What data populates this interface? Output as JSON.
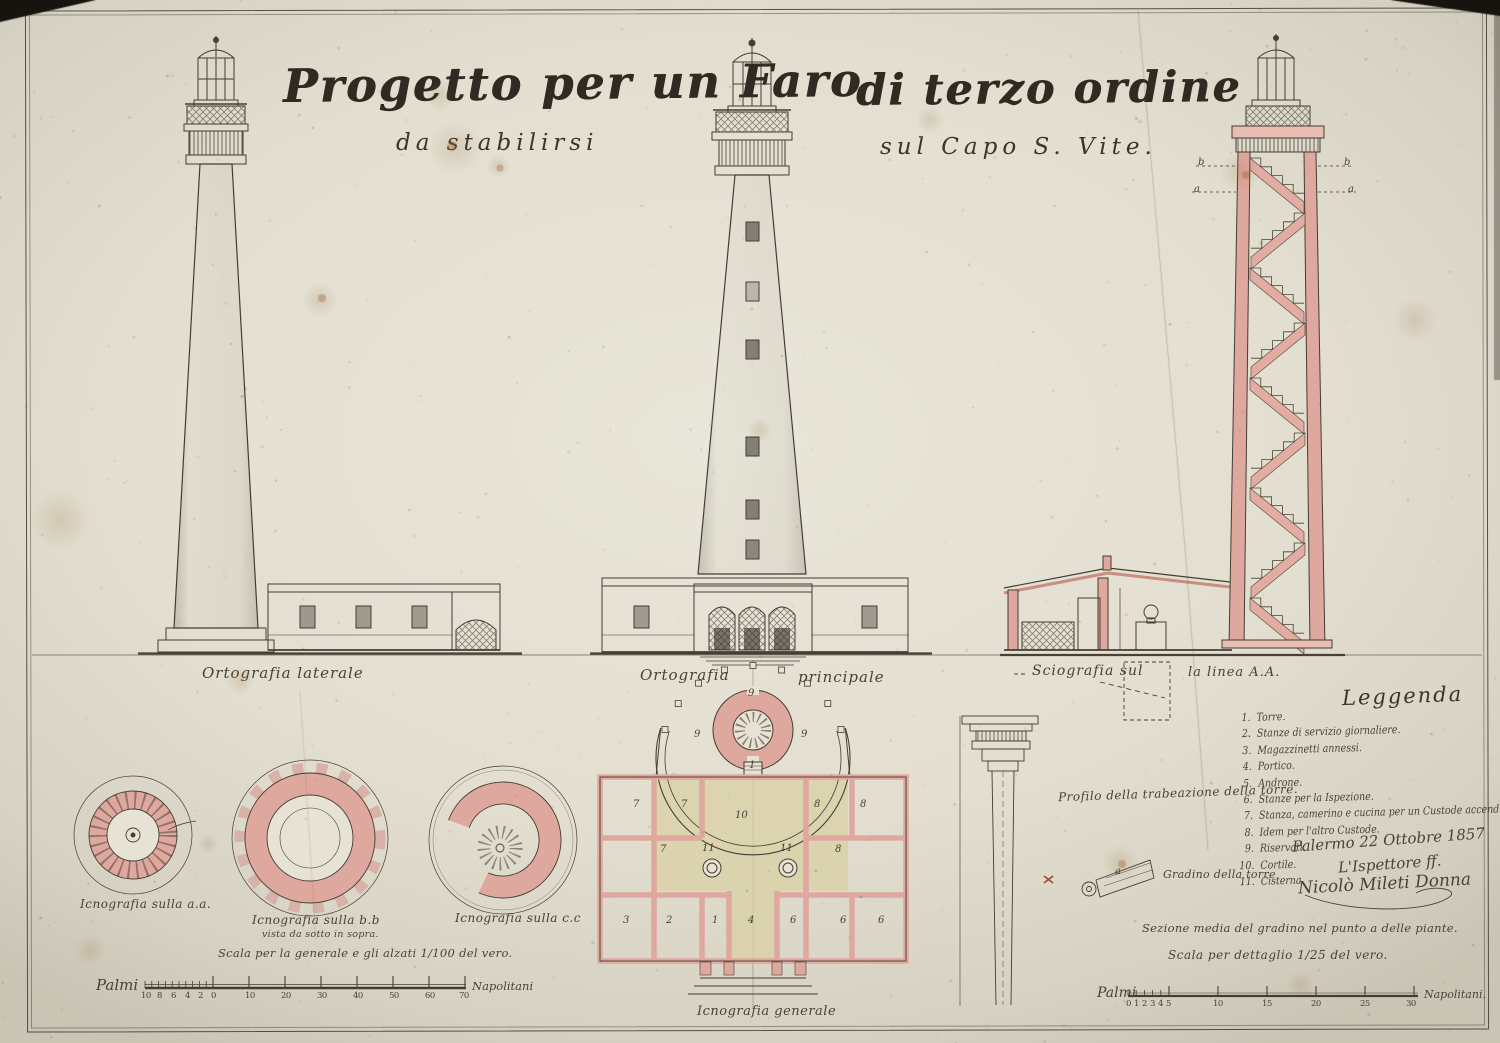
{
  "title": {
    "line1_left": "Progetto per un Faro",
    "line1_right": "di terzo ordine",
    "line2_left": "da stabilirsi",
    "line2_right": "sul Capo S. Vite."
  },
  "labels": {
    "elevation_lateral": "Ortografia laterale",
    "elevation_main_1": "Ortografia",
    "elevation_main_2": "principale",
    "section_1": "Sciografia sul",
    "section_2": "la linea A.A.",
    "plan_aa": "Icnografia sulla a.a.",
    "plan_bb": "Icnografia sulla b.b",
    "plan_bb_sub": "vista da sotto in sopra.",
    "plan_cc": "Icnografia sulla c.c",
    "plan_general": "Icnografia generale",
    "scale_main": "Scala per la generale e gli alzati 1/100 del vero.",
    "trabeazione": "Profilo della trabeazione della torre.",
    "gradino": "Gradino della torre",
    "gradino_section": "Sezione media del gradino nel punto a delle piante.",
    "scale_detail": "Scala per dettaglio 1/25 del vero."
  },
  "legend": {
    "title": "Leggenda",
    "items": [
      {
        "num": "1.",
        "text": "Torre."
      },
      {
        "num": "2.",
        "text": "Stanze di servizio giornaliere."
      },
      {
        "num": "3.",
        "text": "Magazzinetti annessi."
      },
      {
        "num": "4.",
        "text": "Portico."
      },
      {
        "num": "5.",
        "text": "Androne."
      },
      {
        "num": "6.",
        "text": "Stanze per la Ispezione."
      },
      {
        "num": "7.",
        "text": "Stanza, camerino e cucina per un Custode accenditore."
      },
      {
        "num": "8.",
        "text": "Idem per l'altro Custode."
      },
      {
        "num": "9.",
        "text": "Riservati."
      },
      {
        "num": "10.",
        "text": "Cortile."
      },
      {
        "num": "11.",
        "text": "Cisterna."
      }
    ]
  },
  "signature": {
    "line1": "Palermo 22 Ottobre 1857",
    "line2": "L'Ispettore ff.",
    "line3": "Nicolò Mileti Donna"
  },
  "scales": {
    "left": {
      "unit_left": "Palmi",
      "unit_right": "Napolitani"
    },
    "right": {
      "unit_left": "Palmi",
      "unit_right": "Napolitani."
    }
  },
  "colors": {
    "ink": "#443d33",
    "wash_pink": "#dfa89e",
    "wash_pink_light": "#e8bdb2",
    "wash_sand": "#d8d0a2",
    "paper": "#e6e2d4"
  },
  "annotations": [
    {
      "t": "9",
      "x": 748,
      "y": 688,
      "c": "num"
    },
    {
      "t": "9",
      "x": 694,
      "y": 729,
      "c": "num"
    },
    {
      "t": "9",
      "x": 801,
      "y": 729,
      "c": "num"
    },
    {
      "t": "1",
      "x": 749,
      "y": 760,
      "c": "num"
    },
    {
      "t": "10",
      "x": 735,
      "y": 810,
      "c": "num"
    },
    {
      "t": "11",
      "x": 702,
      "y": 843,
      "c": "num"
    },
    {
      "t": "11",
      "x": 780,
      "y": 843,
      "c": "num"
    },
    {
      "t": "7",
      "x": 633,
      "y": 799,
      "c": "num"
    },
    {
      "t": "7",
      "x": 681,
      "y": 799,
      "c": "num"
    },
    {
      "t": "7",
      "x": 660,
      "y": 844,
      "c": "num"
    },
    {
      "t": "8",
      "x": 814,
      "y": 799,
      "c": "num"
    },
    {
      "t": "8",
      "x": 860,
      "y": 799,
      "c": "num"
    },
    {
      "t": "8",
      "x": 835,
      "y": 844,
      "c": "num"
    },
    {
      "t": "3",
      "x": 623,
      "y": 915,
      "c": "num"
    },
    {
      "t": "2",
      "x": 666,
      "y": 915,
      "c": "num"
    },
    {
      "t": "1",
      "x": 712,
      "y": 915,
      "c": "num"
    },
    {
      "t": "4",
      "x": 748,
      "y": 915,
      "c": "num"
    },
    {
      "t": "6",
      "x": 790,
      "y": 915,
      "c": "num"
    },
    {
      "t": "6",
      "x": 840,
      "y": 915,
      "c": "num"
    },
    {
      "t": "6",
      "x": 878,
      "y": 915,
      "c": "num"
    },
    {
      "t": "a",
      "x": 1115,
      "y": 866,
      "c": "num"
    },
    {
      "t": "b",
      "x": 1198,
      "y": 157,
      "c": "let"
    },
    {
      "t": "b",
      "x": 1344,
      "y": 157,
      "c": "let"
    },
    {
      "t": "a",
      "x": 1194,
      "y": 184,
      "c": "let"
    },
    {
      "t": "a",
      "x": 1348,
      "y": 184,
      "c": "let"
    },
    {
      "t": "10",
      "x": 141,
      "y": 991,
      "c": "tick"
    },
    {
      "t": "8",
      "x": 157,
      "y": 991,
      "c": "tick"
    },
    {
      "t": "6",
      "x": 171,
      "y": 991,
      "c": "tick"
    },
    {
      "t": "4",
      "x": 185,
      "y": 991,
      "c": "tick"
    },
    {
      "t": "2",
      "x": 198,
      "y": 991,
      "c": "tick"
    },
    {
      "t": "0",
      "x": 211,
      "y": 991,
      "c": "tick"
    },
    {
      "t": "10",
      "x": 245,
      "y": 991,
      "c": "tick"
    },
    {
      "t": "20",
      "x": 281,
      "y": 991,
      "c": "tick"
    },
    {
      "t": "30",
      "x": 317,
      "y": 991,
      "c": "tick"
    },
    {
      "t": "40",
      "x": 353,
      "y": 991,
      "c": "tick"
    },
    {
      "t": "50",
      "x": 389,
      "y": 991,
      "c": "tick"
    },
    {
      "t": "60",
      "x": 425,
      "y": 991,
      "c": "tick"
    },
    {
      "t": "70",
      "x": 459,
      "y": 991,
      "c": "tick"
    },
    {
      "t": "0",
      "x": 1126,
      "y": 999,
      "c": "tick"
    },
    {
      "t": "1",
      "x": 1134,
      "y": 999,
      "c": "tick"
    },
    {
      "t": "2",
      "x": 1142,
      "y": 999,
      "c": "tick"
    },
    {
      "t": "3",
      "x": 1150,
      "y": 999,
      "c": "tick"
    },
    {
      "t": "4",
      "x": 1158,
      "y": 999,
      "c": "tick"
    },
    {
      "t": "5",
      "x": 1166,
      "y": 999,
      "c": "tick"
    },
    {
      "t": "10",
      "x": 1213,
      "y": 999,
      "c": "tick"
    },
    {
      "t": "15",
      "x": 1262,
      "y": 999,
      "c": "tick"
    },
    {
      "t": "20",
      "x": 1311,
      "y": 999,
      "c": "tick"
    },
    {
      "t": "25",
      "x": 1360,
      "y": 999,
      "c": "tick"
    },
    {
      "t": "30",
      "x": 1406,
      "y": 999,
      "c": "tick"
    }
  ]
}
